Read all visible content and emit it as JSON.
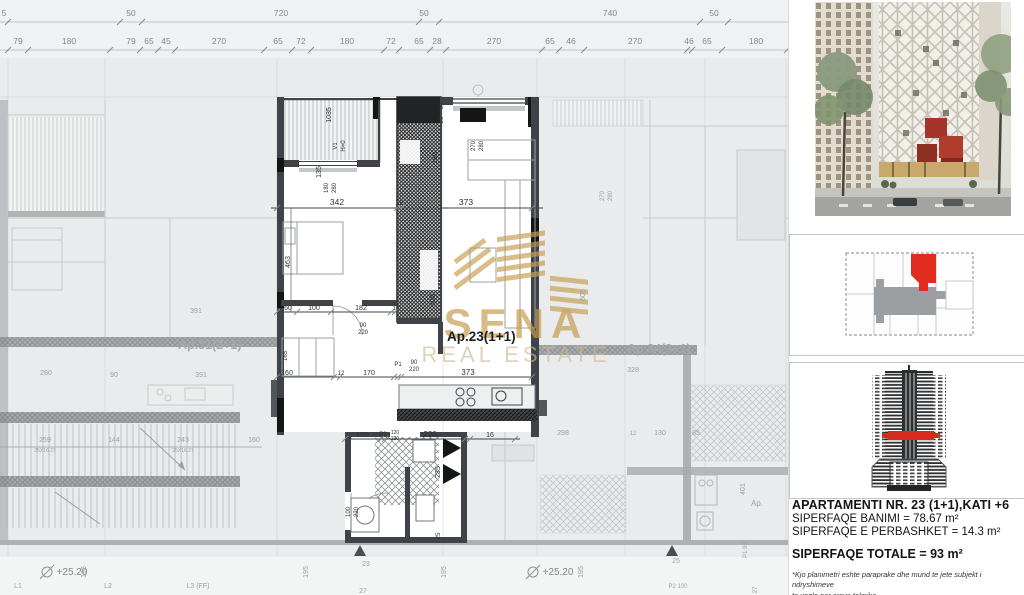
{
  "colors": {
    "plan_bg": "#e9ebec",
    "wall_dark": "#3f4347",
    "wall_black": "#141517",
    "accent_red": "#da2a1e",
    "watermark_gold": "#c49a4e",
    "faded_text": "#9aa0a3",
    "dim_text": "#2e3134",
    "key_gray": "#9c9fa1"
  },
  "plan": {
    "apartment_label": "Ap.23(1+1)",
    "neighbor_left": "Ap.31(2+1)",
    "neighbor_right": "Ap.24(3+1)",
    "balcony_code": "V1",
    "balcony_height": "H=0",
    "level_mark": "+25.20",
    "chain_row1": [
      {
        "t": "5",
        "x": 4
      },
      {
        "t": "50",
        "x": 131
      },
      {
        "t": "720",
        "x": 281
      },
      {
        "t": "50",
        "x": 424
      },
      {
        "t": "740",
        "x": 610
      },
      {
        "t": "50",
        "x": 714
      }
    ],
    "chain_row2": [
      {
        "t": "79",
        "x": 18
      },
      {
        "t": "180",
        "x": 69
      },
      {
        "t": "79",
        "x": 131
      },
      {
        "t": "65",
        "x": 149
      },
      {
        "t": "45",
        "x": 166
      },
      {
        "t": "270",
        "x": 219
      },
      {
        "t": "65",
        "x": 278
      },
      {
        "t": "72",
        "x": 301
      },
      {
        "t": "180",
        "x": 347
      },
      {
        "t": "72",
        "x": 391
      },
      {
        "t": "65",
        "x": 419
      },
      {
        "t": "28",
        "x": 437
      },
      {
        "t": "270",
        "x": 494
      },
      {
        "t": "65",
        "x": 550
      },
      {
        "t": "46",
        "x": 571
      },
      {
        "t": "270",
        "x": 635
      },
      {
        "t": "46",
        "x": 689
      },
      {
        "t": "65",
        "x": 707
      },
      {
        "t": "180",
        "x": 756
      }
    ],
    "dims": [
      {
        "t": "342",
        "x": 337,
        "y": 205
      },
      {
        "t": "12",
        "x": 399,
        "y": 205,
        "s": 7
      },
      {
        "t": "373",
        "x": 466,
        "y": 205
      },
      {
        "t": "1035",
        "x": 331,
        "y": 115,
        "r": 1,
        "s": 7
      },
      {
        "t": "135",
        "x": 321,
        "y": 172,
        "r": 1,
        "s": 7
      },
      {
        "t": "V1",
        "x": 337,
        "y": 146,
        "r": 1,
        "s": 6
      },
      {
        "t": "H=0",
        "x": 345,
        "y": 146,
        "r": 1,
        "s": 6
      },
      {
        "t": "180",
        "x": 328,
        "y": 188,
        "r": 1,
        "s": 6
      },
      {
        "t": "280",
        "x": 336,
        "y": 188,
        "r": 1,
        "s": 6
      },
      {
        "t": "463",
        "x": 290,
        "y": 262,
        "r": 1,
        "s": 7
      },
      {
        "t": "50",
        "x": 443,
        "y": 106,
        "r": 1,
        "s": 6
      },
      {
        "t": "20",
        "x": 443,
        "y": 120,
        "r": 1,
        "s": 6
      },
      {
        "t": "180",
        "x": 437,
        "y": 158,
        "r": 1,
        "s": 7
      },
      {
        "t": "270",
        "x": 475,
        "y": 146,
        "r": 1,
        "s": 6
      },
      {
        "t": "280",
        "x": 483,
        "y": 146,
        "r": 1,
        "s": 6
      },
      {
        "t": "605",
        "x": 435,
        "y": 300,
        "r": 1,
        "s": 7
      },
      {
        "t": "60",
        "x": 288,
        "y": 310,
        "s": 7
      },
      {
        "t": "100",
        "x": 314,
        "y": 310,
        "s": 7
      },
      {
        "t": "182",
        "x": 361,
        "y": 310,
        "s": 7
      },
      {
        "t": "12",
        "x": 396,
        "y": 310,
        "s": 6
      },
      {
        "t": "90",
        "x": 363,
        "y": 327,
        "s": 6
      },
      {
        "t": "220",
        "x": 363,
        "y": 334,
        "s": 6
      },
      {
        "t": "165",
        "x": 287,
        "y": 356,
        "r": 1,
        "s": 6
      },
      {
        "t": "160",
        "x": 287,
        "y": 375,
        "s": 7
      },
      {
        "t": "12",
        "x": 341,
        "y": 375,
        "s": 6
      },
      {
        "t": "170",
        "x": 369,
        "y": 375,
        "s": 7
      },
      {
        "t": "P1",
        "x": 398,
        "y": 366,
        "s": 6
      },
      {
        "t": "90",
        "x": 414,
        "y": 364,
        "s": 6
      },
      {
        "t": "220",
        "x": 414,
        "y": 371,
        "s": 6
      },
      {
        "t": "373",
        "x": 468,
        "y": 375,
        "s": 8
      },
      {
        "t": "120",
        "x": 362,
        "y": 437,
        "s": 7
      },
      {
        "t": "P3",
        "x": 383,
        "y": 436,
        "s": 6
      },
      {
        "t": "120",
        "x": 395,
        "y": 434,
        "s": 5
      },
      {
        "t": "220",
        "x": 395,
        "y": 440,
        "s": 5
      },
      {
        "t": "220",
        "x": 430,
        "y": 437,
        "s": 8
      },
      {
        "t": "16",
        "x": 490,
        "y": 437,
        "s": 7
      },
      {
        "t": "235",
        "x": 440,
        "y": 472,
        "r": 1,
        "s": 7
      },
      {
        "t": "100",
        "x": 350,
        "y": 512,
        "r": 1,
        "s": 6
      },
      {
        "t": "220",
        "x": 358,
        "y": 512,
        "r": 1,
        "s": 6
      },
      {
        "t": "25",
        "x": 440,
        "y": 536,
        "r": 1,
        "s": 6
      }
    ],
    "dims_faded": [
      {
        "t": "391",
        "x": 196,
        "y": 313,
        "s": 7
      },
      {
        "t": "605",
        "x": 585,
        "y": 295,
        "r": 1,
        "s": 7
      },
      {
        "t": "328",
        "x": 633,
        "y": 372,
        "s": 7
      },
      {
        "t": "270",
        "x": 604,
        "y": 196,
        "r": 1,
        "s": 6
      },
      {
        "t": "280",
        "x": 612,
        "y": 196,
        "r": 1,
        "s": 6
      },
      {
        "t": "280",
        "x": 46,
        "y": 375,
        "s": 7
      },
      {
        "t": "90",
        "x": 114,
        "y": 377,
        "s": 7
      },
      {
        "t": "391",
        "x": 201,
        "y": 377,
        "s": 7
      },
      {
        "t": "259",
        "x": 45,
        "y": 442,
        "s": 7
      },
      {
        "t": "144",
        "x": 114,
        "y": 442,
        "s": 7
      },
      {
        "t": "243",
        "x": 183,
        "y": 442,
        "s": 7
      },
      {
        "t": "160",
        "x": 254,
        "y": 442,
        "s": 7
      },
      {
        "t": "25X16.27",
        "x": 45,
        "y": 452,
        "s": 5
      },
      {
        "t": "25X16.27",
        "x": 183,
        "y": 452,
        "s": 5
      },
      {
        "t": "298",
        "x": 563,
        "y": 435,
        "s": 7
      },
      {
        "t": "12",
        "x": 633,
        "y": 435,
        "s": 6
      },
      {
        "t": "130",
        "x": 660,
        "y": 435,
        "s": 7
      },
      {
        "t": "85",
        "x": 696,
        "y": 435,
        "s": 7
      },
      {
        "t": "401",
        "x": 745,
        "y": 489,
        "r": 1,
        "s": 7
      },
      {
        "t": "Ap.",
        "x": 757,
        "y": 506,
        "s": 8
      },
      {
        "t": "195",
        "x": 86,
        "y": 572,
        "r": 1,
        "s": 7
      },
      {
        "t": "195",
        "x": 308,
        "y": 572,
        "r": 1,
        "s": 7
      },
      {
        "t": "195",
        "x": 446,
        "y": 572,
        "r": 1,
        "s": 7
      },
      {
        "t": "195",
        "x": 583,
        "y": 572,
        "r": 1,
        "s": 7
      },
      {
        "t": "L1",
        "x": 18,
        "y": 588,
        "s": 7
      },
      {
        "t": "L2",
        "x": 108,
        "y": 588,
        "s": 7
      },
      {
        "t": "L3 (FF)",
        "x": 198,
        "y": 588,
        "s": 7
      },
      {
        "t": "23",
        "x": 366,
        "y": 566,
        "s": 7
      },
      {
        "t": "27",
        "x": 363,
        "y": 593,
        "s": 7
      },
      {
        "t": "25",
        "x": 676,
        "y": 563,
        "s": 7
      },
      {
        "t": "P2 100",
        "x": 678,
        "y": 588,
        "s": 6
      },
      {
        "t": "P1 90",
        "x": 747,
        "y": 550,
        "r": 1,
        "s": 6
      },
      {
        "t": "27",
        "x": 757,
        "y": 590,
        "r": 1,
        "s": 6
      }
    ],
    "levels": [
      {
        "x": 60,
        "y": 575
      },
      {
        "x": 546,
        "y": 575
      }
    ]
  },
  "watermark": {
    "brand": "SENA",
    "tagline": "REAL ESTATE"
  },
  "sidebar": {
    "info": {
      "line1": "APARTAMENTI NR. 23 (1+1),KATI +6",
      "line2": "SIPERFAQE BANIMI = 78.67 m²",
      "line3": "SIPERFAQE E PERBASHKET = 14.3 m²",
      "total": "SIPERFAQE TOTALE = 93 m²",
      "note_line1": "*Kjo planimetri eshte paraprake dhe mund te jete subjekt i ndryshimeve",
      "note_line2": "te vogla per arsye teknike"
    }
  }
}
